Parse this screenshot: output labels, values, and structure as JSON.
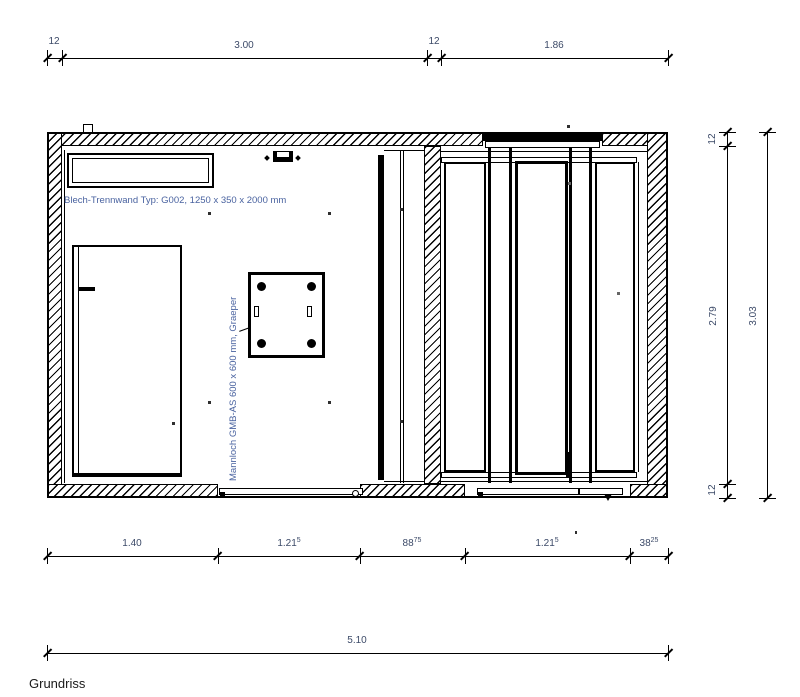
{
  "title": {
    "label": "Grundriss"
  },
  "annotations": {
    "blech_trennwand": "Blech-Trennwand Typ: G002, 1250 x 350 x 2000 mm",
    "mannloch": "Mannloch GMB-AS 600 x 600 mm, Graeper"
  },
  "dimensions": {
    "top": {
      "wall_left": "12",
      "room_left": "3.00",
      "partition": "12",
      "room_right": "1.86"
    },
    "bottom": {
      "d1": {
        "main": "1.40",
        "sup": ""
      },
      "d2": {
        "main": "1.21",
        "sup": "5"
      },
      "d3": {
        "main": "88",
        "sup": "75"
      },
      "d4": {
        "main": "1.21",
        "sup": "5"
      },
      "d5": {
        "main": "38",
        "sup": "25"
      }
    },
    "right": {
      "wall_top": "12",
      "room": "2.79",
      "wall_bottom": "12",
      "overall": "3.03"
    },
    "overall_width": "5.10"
  },
  "colors": {
    "line": "#000000",
    "annotation_text": "#4a63a0",
    "dimension_text": "#3c4a68",
    "title_text": "#1a1a1a"
  }
}
